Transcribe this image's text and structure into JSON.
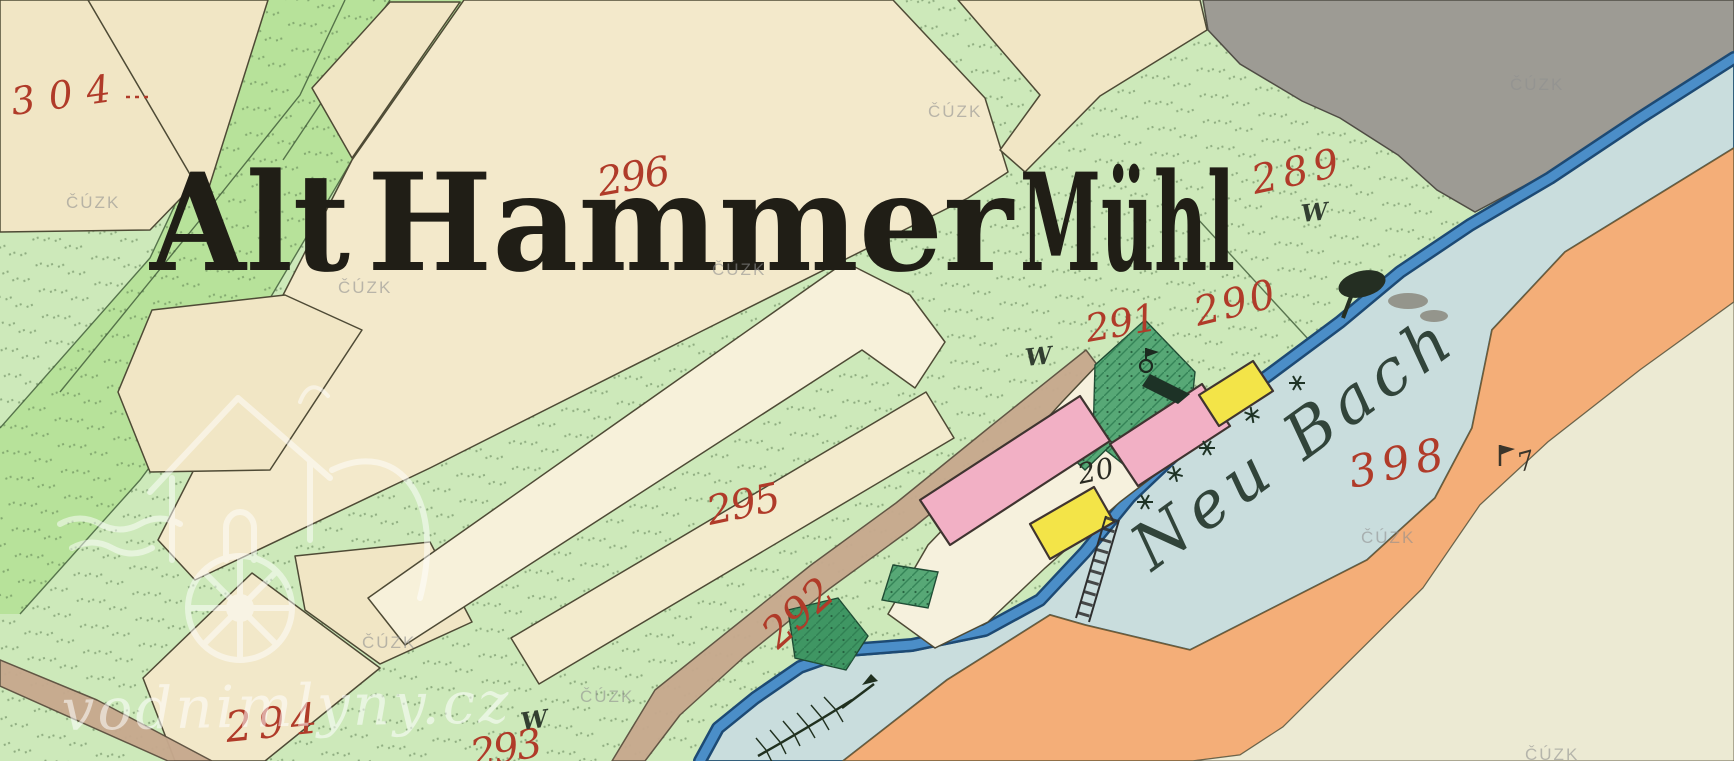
{
  "map": {
    "title": "Alt Hammer Mühl",
    "title_words": [
      "Alt",
      "Hammer",
      "Mühl"
    ],
    "river_label": "Neu Bach",
    "parcel_numbers": [
      "304",
      "296",
      "289",
      "290",
      "291",
      "295",
      "292",
      "293",
      "294",
      "398"
    ],
    "house_number": "20",
    "meadow_mark": "W",
    "symbol_number": "7"
  },
  "watermarks": {
    "cadastre": "ČÚZK",
    "site": "vodnimlyny.cz"
  },
  "legend_semantics": {
    "pink_building": "masonry building",
    "yellow_building": "wooden building",
    "dark_green_hatch": "garden",
    "pale_green": "meadow",
    "cream": "field parcel",
    "gray": "forest",
    "blue_line": "stream",
    "pale_blue": "water / mill pond",
    "orange_band": "riverbank slope",
    "tan_band": "road"
  },
  "colors": {
    "meadow_green": "#cde9ba",
    "bright_green": "#b7e29a",
    "garden_green": "#57a876",
    "cream": "#f1e6c5",
    "strip_white": "#f7f1da",
    "gray_forest": "#9d9b94",
    "stream_blue": "#4b8ec8",
    "stream_edge": "#1d4a74",
    "water_pale": "#c9dddd",
    "orange_band": "#f4ae78",
    "road_tan": "#c7a98e",
    "building_pink": "#f2b0c5",
    "building_yellow": "#f3e448",
    "number_red": "#b03b29",
    "ink_black": "#201e16"
  }
}
